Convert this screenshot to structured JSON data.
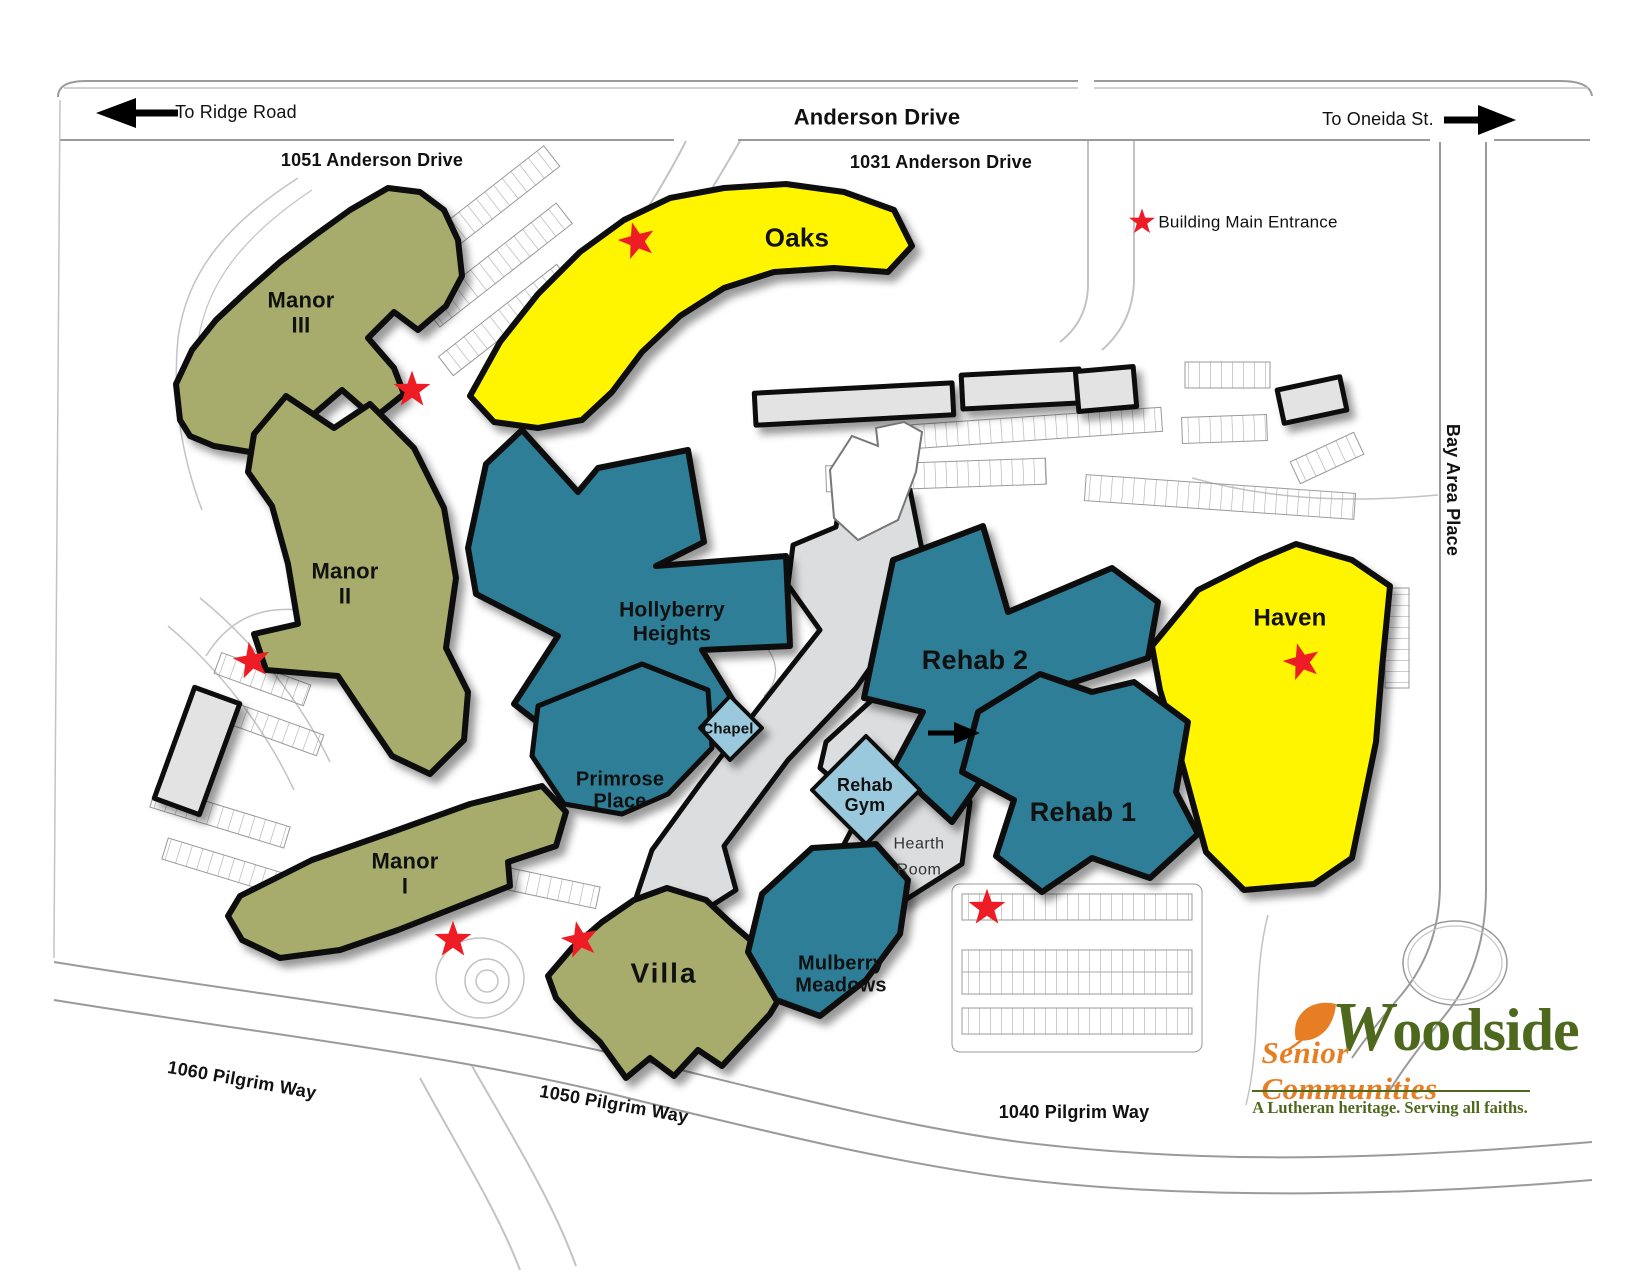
{
  "streets": {
    "anderson_drive": "Anderson Drive",
    "bay_area_place": "Bay Area Place",
    "to_ridge_road": "To Ridge Road",
    "to_oneida_st": "To Oneida St."
  },
  "addresses": {
    "a1051": "1051 Anderson Drive",
    "a1031": "1031 Anderson Drive",
    "p1060": "1060 Pilgrim Way",
    "p1050": "1050 Pilgrim Way",
    "p1040": "1040 Pilgrim Way"
  },
  "legend": {
    "main_entrance": "Building Main Entrance",
    "symbol": "red-star"
  },
  "buildings": {
    "manor_iii": {
      "label": "Manor\nIII",
      "color_key": "olive"
    },
    "manor_ii": {
      "label": "Manor\nII",
      "color_key": "olive"
    },
    "manor_i": {
      "label": "Manor\nI",
      "color_key": "olive"
    },
    "villa": {
      "label": "Villa",
      "color_key": "olive"
    },
    "oaks": {
      "label": "Oaks",
      "color_key": "yellow"
    },
    "haven": {
      "label": "Haven",
      "color_key": "yellow"
    },
    "hollyberry_heights": {
      "label": "Hollyberry\nHeights",
      "color_key": "teal"
    },
    "rehab_2": {
      "label": "Rehab 2",
      "color_key": "teal"
    },
    "rehab_1": {
      "label": "Rehab 1",
      "color_key": "teal"
    },
    "primrose_place": {
      "label": "Primrose\nPlace",
      "color_key": "teal"
    },
    "mulberry_meadows": {
      "label": "Mulberry\nMeadows",
      "color_key": "teal"
    },
    "chapel": {
      "label": "Chapel",
      "color_key": "light_blue"
    },
    "rehab_gym": {
      "label": "Rehab\nGym",
      "color_key": "light_blue"
    },
    "hearth_room": {
      "label": "Hearth\nRoom",
      "color_key": "corridor_gray"
    }
  },
  "logo": {
    "name": "Woodside",
    "subtitle": "Senior Communities",
    "tagline": "A Lutheran heritage. Serving all faiths."
  },
  "colors": {
    "olive": "#A7AB6C",
    "teal": "#2F7E97",
    "light_blue": "#9AC9DD",
    "yellow": "#FFF500",
    "corridor_gray": "#DCDDDE",
    "building_gray": "#E3E3E3",
    "outline": "#0D0D0D",
    "star_red": "#EE1C25",
    "road": "#9A9A9A",
    "road_light": "#C3C3C3",
    "label": "#111111",
    "hearth_text": "#333333",
    "logo_green": "#4E681E",
    "logo_orange": "#E87E23"
  }
}
